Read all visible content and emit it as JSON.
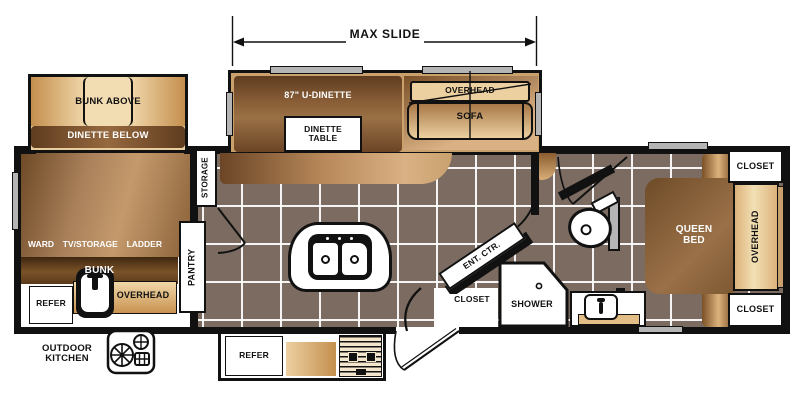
{
  "fp": {
    "dimension_label": "MAX SLIDE",
    "bunk_slide": {
      "bunk_above": "BUNK ABOVE",
      "dinette_below": "DINETTE BELOW"
    },
    "main_slide": {
      "u_dinette": "87\" U-DINETTE",
      "dinette_table_line1": "DINETTE",
      "dinette_table_line2": "TABLE",
      "overhead": "OVERHEAD",
      "sofa": "SOFA"
    },
    "bunk_room": {
      "ward": "WARD",
      "tv_storage": "TV/STORAGE",
      "ladder": "LADDER",
      "bunk": "BUNK",
      "refer": "REFER",
      "overhead": "OVERHEAD"
    },
    "kitchen": {
      "storage": "STORAGE",
      "pantry": "PANTRY",
      "refer": "REFER"
    },
    "exterior": {
      "outdoor_kitchen_line1": "OUTDOOR",
      "outdoor_kitchen_line2": "KITCHEN"
    },
    "living": {
      "ent_ctr": "ENT. CTR.",
      "closet": "CLOSET"
    },
    "bath": {
      "shower": "SHOWER"
    },
    "bedroom": {
      "queen_line1": "QUEEN",
      "queen_line2": "BED",
      "overhead": "OVERHEAD",
      "closet_top": "CLOSET",
      "closet_bottom": "CLOSET"
    }
  },
  "icons": {
    "island_double_sink": "double-basin-sink",
    "galley_sink": "single-basin-sink",
    "vanity_sink": "bath-sink",
    "toilet": "toilet",
    "shower_drain": "drain-dot",
    "outdoor_stove": "two-burner-cooktop",
    "range": "striped-cooktop",
    "window": "gray-bar",
    "door_swing": "arc"
  },
  "colors": {
    "wall": "#111111",
    "tile_floor": "#7b6b60",
    "grout": "#ffffff",
    "wood_dark": "#6b4526",
    "wood_light": "#dcb27c",
    "tan": "#ecd0a0",
    "slide_interior": "#caa06c",
    "window_gray": "#b5b5b5"
  }
}
